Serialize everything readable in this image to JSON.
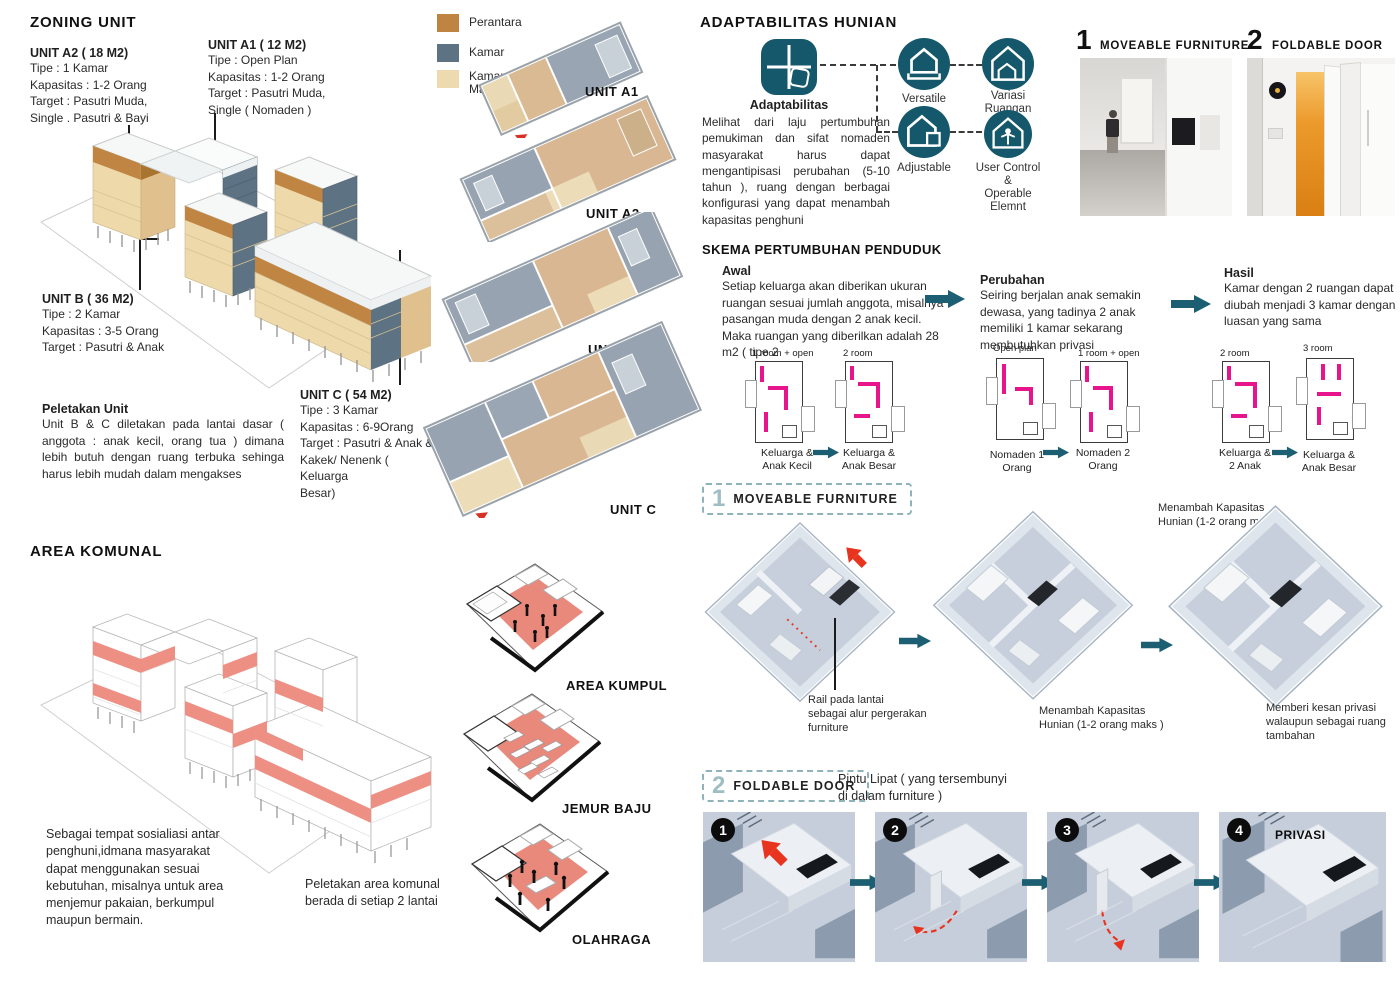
{
  "colors": {
    "teal": "#15576b",
    "arrow_teal": "#1d5f72",
    "perantara": "#bf8442",
    "kamar": "#5d7384",
    "kamar_mandi": "#eddaae",
    "komunal_red": "#e8897c",
    "plan_magenta": "#e8148c",
    "arrow_red": "#e8331f"
  },
  "legend": {
    "items": [
      {
        "label": "Perantara"
      },
      {
        "label": "Kamar"
      },
      {
        "label": "Kamar\nMandi"
      }
    ]
  },
  "zoning": {
    "title": "ZONING UNIT",
    "unit_a2": {
      "name": "UNIT A2 ( 18 M2)",
      "desc": "Tipe : 1 Kamar\nKapasitas : 1-2 Orang\nTarget : Pasutri Muda,\nSingle . Pasutri & Bayi"
    },
    "unit_a1": {
      "name": "UNIT A1 ( 12 M2)",
      "desc": "Tipe : Open Plan\nKapasitas : 1-2 Orang\nTarget : Pasutri Muda,\nSingle ( Nomaden )"
    },
    "unit_b": {
      "name": "UNIT B ( 36 M2)",
      "desc": "Tipe : 2 Kamar\nKapasitas : 3-5 Orang\nTarget : Pasutri & Anak"
    },
    "unit_c": {
      "name": "UNIT C ( 54 M2)",
      "desc": "Tipe : 3 Kamar\nKapasitas : 6-9Orang\nTarget : Pasutri & Anak &\nKakek/ Nenenk ( Keluarga\nBesar)"
    },
    "peletakan": {
      "title": "Peletakan  Unit",
      "desc": "Unit B & C diletakan pada  lantai dasar ( anggota : anak kecil, orang tua ) dimana lebih butuh   dengan ruang terbuka sehinga harus lebih mudah dalam mengakses"
    },
    "plan_labels": [
      "UNIT A1",
      "UNIT A2",
      "UNIT B",
      "UNIT C"
    ]
  },
  "komunal": {
    "title": "AREA KOMUNAL",
    "desc": "Sebagai tempat sosialiasi antar\npenghuni,idmana masyarakat\ndapat menggunakan sesuai\nkebutuhan, misalnya untuk area\nmenjemur pakaian, berkumpul\nmaupun bermain.",
    "note": "Peletakan area komunal\nberada di setiap 2 lantai",
    "plan_labels": [
      "AREA KUMPUL",
      "JEMUR BAJU",
      "OLAHRAGA"
    ]
  },
  "adaptabilitas": {
    "title": "ADAPTABILITAS HUNIAN",
    "hub_label": "Adaptabilitas",
    "desc": "Melihat dari laju pertumbuhan pemukiman dan sifat nomaden masyarakat harus dapat mengantipisasi perubahan (5-10 tahun ), ruang dengan berbagai konfigurasi yang dapat menambah kapasitas penghuni",
    "icons": [
      {
        "label": "Versatile"
      },
      {
        "label": "Variasi\nRuangan"
      },
      {
        "label": "Adjustable"
      },
      {
        "label": "User Control\n&\nOperable\nElemnt"
      }
    ],
    "photos": [
      {
        "num": "1",
        "label": "MOVEABLE FURNITURE"
      },
      {
        "num": "2",
        "label": "FOLDABLE DOOR"
      }
    ]
  },
  "skema": {
    "title": "SKEMA PERTUMBUHAN PENDUDUK",
    "stages": [
      {
        "heading": "Awal",
        "desc": "Setiap keluarga akan diberikan ukuran ruangan sesuai jumlah anggota, misalnya pasangan muda dengan 2 anak kecil. Maka ruangan yang diberilkan adalah 28 m2 ( tipe 2"
      },
      {
        "heading": "Perubahan",
        "desc": "Seiring berjalan anak semakin dewasa, yang tadinya 2 anak memiliki 1 kamar sekarang membutuhkan privasi"
      },
      {
        "heading": "Hasil",
        "desc": "Kamar dengan 2 ruangan dapat diubah menjadi 3 kamar dengan luasan yang sama"
      }
    ],
    "plans": [
      {
        "top": "1 room + open",
        "cap": "Keluarga &\nAnak Kecil"
      },
      {
        "top": "2 room",
        "cap": "Keluarga &\nAnak Besar"
      },
      {
        "top": "Open plan",
        "cap": "Nomaden 1\nOrang"
      },
      {
        "top": "1 room + open",
        "cap": "Nomaden 2\nOrang"
      },
      {
        "top": "2 room",
        "cap": "Keluarga &\n2 Anak"
      },
      {
        "top": "3 room",
        "cap": "Keluarga &\nAnak Besar"
      }
    ]
  },
  "moveable": {
    "num": "1",
    "title": "MOVEABLE FURNITURE",
    "callout_top": "Menambah Kapasitas\nHunian (1-2 orang maks )",
    "captions": [
      "Rail pada lantai\nsebagai alur pergerakan\nfurniture",
      "Menambah Kapasitas\nHunian (1-2 orang maks )",
      "Memberi kesan privasi\nwalaupun sebagai ruang\ntambahan"
    ]
  },
  "foldable": {
    "num": "2",
    "title": "FOLDABLE DOOR",
    "subtitle": "Pintu Lipat ( yang tersembunyi\ndi dalam furniture )",
    "steps": [
      "1",
      "2",
      "3",
      "4"
    ],
    "privasi_label": "PRIVASI"
  }
}
